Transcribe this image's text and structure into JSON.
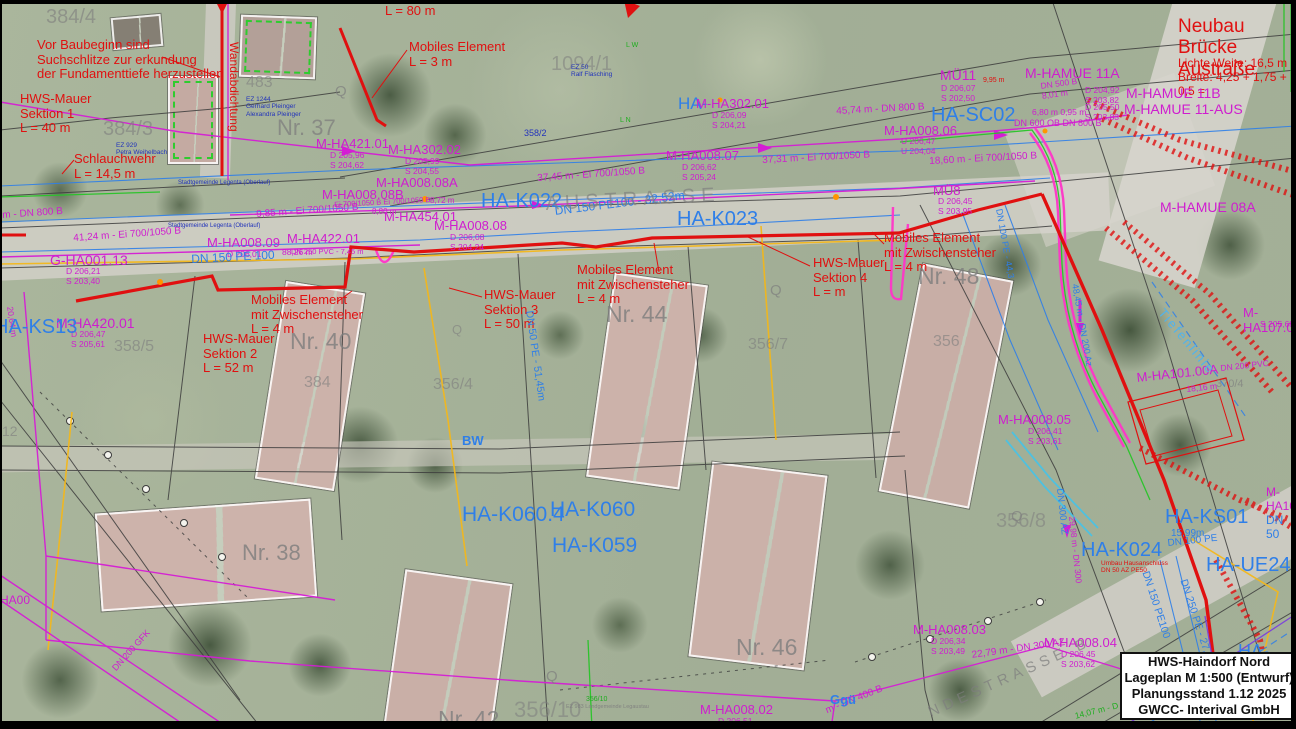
{
  "meta": {
    "plan_width": 1296,
    "plan_height": 729
  },
  "title_block": {
    "line1": "HWS-Haindorf Nord",
    "line2": "Lageplan M 1:500 (Entwurf)",
    "line3": "Planungsstand 1.12 2025",
    "line4": "GWCC- Interival GmbH"
  },
  "colors": {
    "red": "#e01010",
    "mag": "#cf1dcf",
    "blu": "#2f7fe8",
    "cy": "#4fb3ee",
    "gry": "#7e7e7e",
    "grn": "#1fae1f",
    "dblu": "#2233bb"
  },
  "houses": [
    {
      "n": "nr37-house",
      "x": 240,
      "y": 16,
      "w": 72,
      "h": 58,
      "r": 2,
      "roof": "#b3a098",
      "dash": true
    },
    {
      "n": "parcel-house",
      "x": 168,
      "y": 76,
      "w": 46,
      "h": 84,
      "r": 0,
      "roof": "#c4aaa2",
      "dash": true
    },
    {
      "n": "shed",
      "x": 112,
      "y": 16,
      "w": 46,
      "h": 28,
      "r": -5,
      "roof": "#857f74",
      "dash": false
    },
    {
      "n": "nr40-house",
      "x": 270,
      "y": 286,
      "w": 76,
      "h": 196,
      "r": 9,
      "roof": "#ccb2aa",
      "dash": false
    },
    {
      "n": "nr44-house",
      "x": 600,
      "y": 278,
      "w": 90,
      "h": 202,
      "r": 8,
      "roof": "#ccb2aa",
      "dash": false
    },
    {
      "n": "nr48-house",
      "x": 900,
      "y": 270,
      "w": 88,
      "h": 228,
      "r": 11,
      "roof": "#c8aea6",
      "dash": false
    },
    {
      "n": "nr38-house",
      "x": 98,
      "y": 506,
      "w": 212,
      "h": 94,
      "r": -4,
      "roof": "#cdb3ab",
      "dash": false
    },
    {
      "n": "nr42-house",
      "x": 394,
      "y": 576,
      "w": 104,
      "h": 153,
      "r": 8,
      "roof": "#c9afa7",
      "dash": false
    },
    {
      "n": "nr46-house",
      "x": 700,
      "y": 468,
      "w": 112,
      "h": 192,
      "r": 7,
      "roof": "#cbb1a9",
      "dash": false
    }
  ],
  "labels": [
    {
      "n": "note-suchschlitze",
      "t": "Vor Baubeginn sind\nSuchschlitze zur erkundung\nder Fundamenttiefe herzustellen",
      "x": 37,
      "y": 38,
      "c": "red",
      "s": 13
    },
    {
      "n": "hws-mauer-sektion-1",
      "t": "HWS-Mauer\nSektion 1\nL = 40 m",
      "x": 20,
      "y": 92,
      "c": "red",
      "s": 13
    },
    {
      "n": "schlauchwehr",
      "t": "Schlauchwehr\nL = 14,5 m",
      "x": 74,
      "y": 152,
      "c": "red",
      "s": 13
    },
    {
      "n": "wall-l80",
      "t": "L = 80 m",
      "x": 385,
      "y": 4,
      "c": "red",
      "s": 13
    },
    {
      "n": "mobiles-element-3m",
      "t": "Mobiles Element\nL = 3 m",
      "x": 409,
      "y": 40,
      "c": "red",
      "s": 13
    },
    {
      "n": "neubau-bruecke-austrasse",
      "t": "Neubau\nBrücke Austraße",
      "x": 1178,
      "y": 16,
      "c": "red",
      "s": 19
    },
    {
      "n": "lichte-weite",
      "t": "Lichte Weite: 16,5 m",
      "x": 1178,
      "y": 57,
      "c": "red",
      "s": 12
    },
    {
      "n": "breite",
      "t": "Breite: 4,25 + 1,75 + 0,5 = ",
      "x": 1178,
      "y": 71,
      "c": "red",
      "s": 12
    },
    {
      "n": "wandabdichtung",
      "t": "Wandabdichtung",
      "x": 240,
      "y": 42,
      "c": "red",
      "s": 12,
      "r": 90
    },
    {
      "n": "mobiles-element-zw-1",
      "t": "Mobiles Element\nmit Zwischensteher\nL = 4 m",
      "x": 251,
      "y": 293,
      "c": "red",
      "s": 13
    },
    {
      "n": "hws-mauer-sektion-2",
      "t": "HWS-Mauer\nSektion 2\nL = 52 m",
      "x": 203,
      "y": 332,
      "c": "red",
      "s": 13
    },
    {
      "n": "hws-mauer-sektion-3",
      "t": "HWS-Mauer\nSektion 3\nL = 50 m",
      "x": 484,
      "y": 288,
      "c": "red",
      "s": 13
    },
    {
      "n": "mobiles-element-zw-2",
      "t": "Mobiles Element\nmit Zwischensteher\nL = 4 m",
      "x": 577,
      "y": 263,
      "c": "red",
      "s": 13
    },
    {
      "n": "hws-mauer-sektion-4",
      "t": "HWS-Mauer\nSektion 4\nL =    m",
      "x": 813,
      "y": 256,
      "c": "red",
      "s": 13
    },
    {
      "n": "mobiles-element-zw-3",
      "t": "Mobiles Element\nmit Zwischensteher\nL = 4 m",
      "x": 884,
      "y": 231,
      "c": "red",
      "s": 13
    },
    {
      "n": "umbau-hausanschluss",
      "t": "Umbau Hausanschluss\nDN 50 AZ PE50",
      "x": 1101,
      "y": 560,
      "c": "red",
      "s": 6.5
    },
    {
      "n": "dim-9-95",
      "t": "9,95 m",
      "x": 983,
      "y": 77,
      "c": "red",
      "s": 7
    },
    {
      "t": "M-HA421.01",
      "x": 316,
      "y": 137,
      "c": "mag",
      "s": 13
    },
    {
      "t": "D 205,96\nS 204,62",
      "x": 330,
      "y": 151,
      "c": "mag",
      "s": 8.5
    },
    {
      "t": "M-HA302.02",
      "x": 388,
      "y": 143,
      "c": "mag",
      "s": 13
    },
    {
      "t": "D 205,99\nS 204,55",
      "x": 405,
      "y": 157,
      "c": "mag",
      "s": 8.5
    },
    {
      "t": "HA-",
      "x": 678,
      "y": 94,
      "c": "blu",
      "s": 17
    },
    {
      "t": "M-HA302.01",
      "x": 696,
      "y": 97,
      "c": "mag",
      "s": 13
    },
    {
      "t": "D 206,09\nS 204,21",
      "x": 712,
      "y": 111,
      "c": "mag",
      "s": 8.5
    },
    {
      "t": "M-HA008.08A",
      "x": 376,
      "y": 176,
      "c": "mag",
      "s": 13
    },
    {
      "t": "M-HA008.08B",
      "x": 322,
      "y": 188,
      "c": "mag",
      "s": 13
    },
    {
      "t": "Ei 700/1050 B  Ei 700/1050 B",
      "x": 334,
      "y": 201,
      "c": "mag",
      "s": 7.5,
      "r": -3
    },
    {
      "t": "8,80 m",
      "x": 372,
      "y": 207,
      "c": "mag",
      "s": 8
    },
    {
      "t": "8,72 m",
      "x": 430,
      "y": 196,
      "c": "mag",
      "s": 8
    },
    {
      "t": "M-HA454.01",
      "x": 384,
      "y": 210,
      "c": "mag",
      "s": 13
    },
    {
      "t": "M-HA008.08",
      "x": 434,
      "y": 219,
      "c": "mag",
      "s": 13
    },
    {
      "t": "D 206,08\nS 204,24",
      "x": 450,
      "y": 233,
      "c": "mag",
      "s": 8.5
    },
    {
      "t": "M-HA422.01",
      "x": 287,
      "y": 232,
      "c": "mag",
      "s": 13
    },
    {
      "t": "DN 250 PVC - 7,45 m",
      "x": 291,
      "y": 248,
      "c": "mag",
      "s": 7.5
    },
    {
      "t": "M-HA008.09",
      "x": 207,
      "y": 236,
      "c": "mag",
      "s": 13
    },
    {
      "t": "D 206,01",
      "x": 227,
      "y": 250,
      "c": "mag",
      "s": 8.5
    },
    {
      "t": "88,26 m",
      "x": 282,
      "y": 248,
      "c": "mag",
      "s": 8.5
    },
    {
      "t": "G-HA001.13",
      "x": 50,
      "y": 253,
      "c": "mag",
      "s": 14
    },
    {
      "t": "D 206,21\nS 203,40",
      "x": 66,
      "y": 267,
      "c": "mag",
      "s": 8.5
    },
    {
      "t": "M-HA420.01",
      "x": 56,
      "y": 316,
      "c": "mag",
      "s": 14
    },
    {
      "t": "D 206,47\nS 205,61",
      "x": 71,
      "y": 330,
      "c": "mag",
      "s": 8.5
    },
    {
      "t": "m - DN 800 B",
      "x": 2,
      "y": 210,
      "c": "mag",
      "s": 10,
      "r": -4
    },
    {
      "t": "41,24 m - Ei 700/1050 B",
      "x": 73,
      "y": 233,
      "c": "mag",
      "s": 10,
      "r": -4
    },
    {
      "t": "9,85 m - Ei 700/1050 B",
      "x": 256,
      "y": 209,
      "c": "mag",
      "s": 10,
      "r": -4
    },
    {
      "t": "37,45 m - Ei 700/1050 B",
      "x": 537,
      "y": 173,
      "c": "mag",
      "s": 10,
      "r": -4
    },
    {
      "t": "37,31 m - Ei 700/1050 B",
      "x": 762,
      "y": 155,
      "c": "mag",
      "s": 10,
      "r": -3
    },
    {
      "t": "18,60 m - Ei 700/1050 B",
      "x": 929,
      "y": 156,
      "c": "mag",
      "s": 10,
      "r": -3
    },
    {
      "t": "45,74 m - DN 800 B",
      "x": 836,
      "y": 106,
      "c": "mag",
      "s": 10,
      "r": -3
    },
    {
      "t": "M-HA008.07",
      "x": 666,
      "y": 149,
      "c": "mag",
      "s": 13
    },
    {
      "t": "D 206,62\nS 205,24",
      "x": 682,
      "y": 163,
      "c": "mag",
      "s": 8.5
    },
    {
      "t": "M-HA008.06",
      "x": 884,
      "y": 124,
      "c": "mag",
      "s": 13
    },
    {
      "t": "U 206,47\nU 204,04",
      "x": 901,
      "y": 137,
      "c": "mag",
      "s": 8.5
    },
    {
      "t": "MÜ11",
      "x": 940,
      "y": 68,
      "c": "mag",
      "s": 14
    },
    {
      "t": "D 206,07\nS 202,50",
      "x": 941,
      "y": 84,
      "c": "mag",
      "s": 8.5
    },
    {
      "t": "M-HAMUE 11A",
      "x": 1025,
      "y": 66,
      "c": "mag",
      "s": 14
    },
    {
      "t": "DN 500 B\n8,01 m",
      "x": 1040,
      "y": 82,
      "c": "mag",
      "s": 8.5,
      "r": -8
    },
    {
      "t": "D 204,92\nS 203,82",
      "x": 1085,
      "y": 86,
      "c": "mag",
      "s": 8.5
    },
    {
      "t": "M-HAMUE 11B",
      "x": 1126,
      "y": 86,
      "c": "mag",
      "s": 14
    },
    {
      "t": "D 205,50\nS 203,83",
      "x": 1085,
      "y": 103,
      "c": "mag",
      "s": 8.5
    },
    {
      "t": "M-HAMUE 11-AUS",
      "x": 1124,
      "y": 102,
      "c": "mag",
      "s": 14
    },
    {
      "t": "6,80 m  0,95 m",
      "x": 1032,
      "y": 108,
      "c": "mag",
      "s": 8.5
    },
    {
      "t": "DN 600 OB  DN 800 B",
      "x": 1014,
      "y": 118,
      "c": "mag",
      "s": 9
    },
    {
      "t": "M-HAMUE 08A",
      "x": 1160,
      "y": 200,
      "c": "mag",
      "s": 14
    },
    {
      "t": "M-HA107.0",
      "x": 1243,
      "y": 306,
      "c": "mag",
      "s": 13
    },
    {
      "t": "S 205,68",
      "x": 1260,
      "y": 320,
      "c": "mag",
      "s": 8.5
    },
    {
      "t": "M-HA101.00A",
      "x": 1136,
      "y": 371,
      "c": "mag",
      "s": 13,
      "r": -6
    },
    {
      "t": "18,16 m",
      "x": 1186,
      "y": 385,
      "c": "mag",
      "s": 8.5,
      "r": -6
    },
    {
      "t": "DN 200 PVC",
      "x": 1220,
      "y": 364,
      "c": "mag",
      "s": 8.5,
      "r": -6
    },
    {
      "t": "M-HA008.05",
      "x": 998,
      "y": 413,
      "c": "mag",
      "s": 13
    },
    {
      "t": "D 206,41\nS 203,61",
      "x": 1028,
      "y": 427,
      "c": "mag",
      "s": 8.5
    },
    {
      "t": "29,98 m - DN 300",
      "x": 1076,
      "y": 516,
      "c": "mag",
      "s": 8.5,
      "r": 84
    },
    {
      "t": "M-HA008.04",
      "x": 1044,
      "y": 636,
      "c": "mag",
      "s": 13
    },
    {
      "t": "D 206,45\nS 203,62",
      "x": 1061,
      "y": 650,
      "c": "mag",
      "s": 8.5
    },
    {
      "t": "22,79 m - DN 300 AZ",
      "x": 971,
      "y": 650,
      "c": "mag",
      "s": 10,
      "r": -8
    },
    {
      "t": "M-HA008.03",
      "x": 913,
      "y": 623,
      "c": "mag",
      "s": 13
    },
    {
      "t": "D 206,34\nS 203,49",
      "x": 931,
      "y": 637,
      "c": "mag",
      "s": 8.5
    },
    {
      "t": "m - DN 400 B",
      "x": 824,
      "y": 706,
      "c": "mag",
      "s": 10,
      "r": -22
    },
    {
      "t": "M-HA008.02",
      "x": 700,
      "y": 703,
      "c": "mag",
      "s": 13
    },
    {
      "t": "D 206,51",
      "x": 718,
      "y": 717,
      "c": "mag",
      "s": 8.5
    },
    {
      "t": "MÜ8",
      "x": 933,
      "y": 184,
      "c": "mag",
      "s": 13
    },
    {
      "t": "D 206,45\nS 203,95",
      "x": 938,
      "y": 197,
      "c": "mag",
      "s": 8.5
    },
    {
      "t": "20,64 m",
      "x": 14,
      "y": 306,
      "c": "mag",
      "s": 8.5,
      "r": 82
    },
    {
      "t": "DN 200 GFK",
      "x": 110,
      "y": 666,
      "c": "mag",
      "s": 9,
      "r": -48
    },
    {
      "t": "HA00",
      "x": 0,
      "y": 594,
      "c": "mag",
      "s": 12
    },
    {
      "t": "M-HA10",
      "x": 1266,
      "y": 486,
      "c": "mag",
      "s": 12
    },
    {
      "t": "14,07 m - D",
      "x": 1074,
      "y": 712,
      "c": "grn",
      "s": 8.5,
      "r": -14
    },
    {
      "t": "HA-K022",
      "x": 481,
      "y": 190,
      "c": "blu",
      "s": 20
    },
    {
      "t": "HA-K023",
      "x": 677,
      "y": 208,
      "c": "blu",
      "s": 20
    },
    {
      "t": "HA-SC02",
      "x": 931,
      "y": 104,
      "c": "blu",
      "s": 20
    },
    {
      "t": "HA-K060.4",
      "x": 462,
      "y": 503,
      "c": "blu",
      "s": 21
    },
    {
      "t": "HA-K060",
      "x": 550,
      "y": 498,
      "c": "blu",
      "s": 21
    },
    {
      "t": "HA-K059",
      "x": 552,
      "y": 534,
      "c": "blu",
      "s": 21
    },
    {
      "t": "HA-K024",
      "x": 1081,
      "y": 539,
      "c": "blu",
      "s": 20
    },
    {
      "t": "HA-KS01",
      "x": 1165,
      "y": 506,
      "c": "blu",
      "s": 20
    },
    {
      "t": "15,99m",
      "x": 1171,
      "y": 528,
      "c": "blu",
      "s": 10
    },
    {
      "t": "DN 100 PE",
      "x": 1167,
      "y": 538,
      "c": "blu",
      "s": 10,
      "r": -6
    },
    {
      "t": "HA-UE24",
      "x": 1206,
      "y": 554,
      "c": "blu",
      "s": 20
    },
    {
      "t": "HA-KS13",
      "x": -6,
      "y": 316,
      "c": "blu",
      "s": 20
    },
    {
      "n": "bw-label",
      "t": "BW",
      "x": 462,
      "y": 434,
      "c": "blu",
      "s": 13,
      "w": 700
    },
    {
      "n": "ggue-label",
      "t": "Ggü",
      "x": 830,
      "y": 693,
      "c": "blu",
      "s": 13,
      "w": 700
    },
    {
      "t": "HA-K02",
      "x": 1238,
      "y": 641,
      "c": "blu",
      "s": 18
    },
    {
      "t": "DN 150 PE 100",
      "x": 191,
      "y": 253,
      "c": "blu",
      "s": 12,
      "r": -3
    },
    {
      "t": "DN 150 PE100 - 32,52m",
      "x": 554,
      "y": 205,
      "c": "blu",
      "s": 12,
      "r": -7
    },
    {
      "t": "DN 50 PE - 51,45m",
      "x": 534,
      "y": 310,
      "c": "blu",
      "s": 10.5,
      "r": 82
    },
    {
      "t": "DN 150 PE100",
      "x": 1150,
      "y": 570,
      "c": "blu",
      "s": 10.5,
      "r": 72
    },
    {
      "t": "DN 250 PE - 27,07",
      "x": 1188,
      "y": 578,
      "c": "blu",
      "s": 10.5,
      "r": 72
    },
    {
      "t": "DN 50",
      "x": 1266,
      "y": 514,
      "c": "blu",
      "s": 12
    },
    {
      "n": "tiefenlinie-label",
      "t": "Tiefenlinie",
      "x": 1166,
      "y": 306,
      "c": "cy",
      "s": 13,
      "r": 50,
      "ls": 2
    },
    {
      "t": "DN 300 AZ",
      "x": 1064,
      "y": 488,
      "c": "blu",
      "s": 9.5,
      "r": 84
    },
    {
      "t": "DN 100 PE - 44,3",
      "x": 1004,
      "y": 208,
      "c": "blu",
      "s": 9,
      "r": 80
    },
    {
      "t": "48,45 m - DN 200 Az",
      "x": 1080,
      "y": 283,
      "c": "blu",
      "s": 9,
      "r": 80
    },
    {
      "t": "358/2",
      "x": 524,
      "y": 128,
      "c": "dblu",
      "s": 9
    },
    {
      "t": "384/4",
      "x": 46,
      "y": 6,
      "c": "gry",
      "s": 20,
      "o": 0.6
    },
    {
      "t": "384/3",
      "x": 103,
      "y": 118,
      "c": "gry",
      "s": 20,
      "o": 0.6
    },
    {
      "t": "483",
      "x": 246,
      "y": 74,
      "c": "gry",
      "s": 16,
      "o": 0.6
    },
    {
      "t": "Nr. 37",
      "x": 277,
      "y": 116,
      "c": "gry",
      "s": 22,
      "o": 0.75
    },
    {
      "t": "1094/1",
      "x": 551,
      "y": 53,
      "c": "gry",
      "s": 20,
      "o": 0.55
    },
    {
      "t": "358/5",
      "x": 114,
      "y": 338,
      "c": "gry",
      "s": 16,
      "o": 0.6
    },
    {
      "t": "356/4",
      "x": 433,
      "y": 376,
      "c": "gry",
      "s": 16,
      "o": 0.6
    },
    {
      "t": "384",
      "x": 304,
      "y": 374,
      "c": "gry",
      "s": 16,
      "o": 0.6
    },
    {
      "t": "356/7",
      "x": 748,
      "y": 336,
      "c": "gry",
      "s": 16,
      "o": 0.6
    },
    {
      "t": "356",
      "x": 933,
      "y": 333,
      "c": "gry",
      "s": 16,
      "o": 0.6
    },
    {
      "t": "356/8",
      "x": 996,
      "y": 510,
      "c": "gry",
      "s": 20,
      "o": 0.55
    },
    {
      "t": "356/10",
      "x": 514,
      "y": 698,
      "c": "gry",
      "s": 22,
      "o": 0.55
    },
    {
      "t": "Nr. 38",
      "x": 242,
      "y": 541,
      "c": "gry",
      "s": 22,
      "o": 0.8
    },
    {
      "t": "Nr. 40",
      "x": 290,
      "y": 328,
      "c": "gry",
      "s": 23,
      "o": 0.8
    },
    {
      "t": "Nr. 42",
      "x": 438,
      "y": 706,
      "c": "gry",
      "s": 23,
      "o": 0.8
    },
    {
      "t": "Nr. 44",
      "x": 606,
      "y": 301,
      "c": "gry",
      "s": 23,
      "o": 0.8
    },
    {
      "t": "Nr. 46",
      "x": 736,
      "y": 634,
      "c": "gry",
      "s": 23,
      "o": 0.8
    },
    {
      "t": "Nr. 48",
      "x": 918,
      "y": 263,
      "c": "gry",
      "s": 23,
      "o": 0.8
    },
    {
      "t": "12",
      "x": 2,
      "y": 424,
      "c": "gry",
      "s": 14,
      "o": 0.6
    },
    {
      "t": "370/4",
      "x": 1216,
      "y": 378,
      "c": "gry",
      "s": 11,
      "o": 0.7
    },
    {
      "n": "street-name-austrasse",
      "t": "AUSTRASSE",
      "x": 545,
      "y": 193,
      "c": "gry",
      "s": 20,
      "ls": 6,
      "r": -3,
      "o": 0.65
    },
    {
      "n": "street-name-landesstrasse",
      "t": "NDESTRASSE B",
      "x": 926,
      "y": 706,
      "c": "gry",
      "s": 15,
      "ls": 5,
      "r": -24,
      "o": 0.7
    },
    {
      "t": "Q",
      "x": 335,
      "y": 84,
      "c": "gry",
      "s": 15,
      "o": 0.7
    },
    {
      "t": "Q",
      "x": 770,
      "y": 283,
      "c": "gry",
      "s": 15,
      "o": 0.7
    },
    {
      "t": "Q",
      "x": 1011,
      "y": 509,
      "c": "gry",
      "s": 15,
      "o": 0.7
    },
    {
      "t": "Q",
      "x": 546,
      "y": 669,
      "c": "gry",
      "s": 15,
      "o": 0.7
    },
    {
      "t": "Q",
      "x": 452,
      "y": 323,
      "c": "gry",
      "s": 13,
      "o": 0.6
    },
    {
      "t": "EZ 1244\nGerhard Pleinger\nAlexandra Pleinger",
      "x": 246,
      "y": 96,
      "c": "dblu",
      "s": 6.5
    },
    {
      "t": "EZ 929\nPetra Weihelbach",
      "x": 116,
      "y": 142,
      "c": "dblu",
      "s": 6.5
    },
    {
      "t": "EZ 50\nRalf Flasching",
      "x": 571,
      "y": 64,
      "c": "dblu",
      "s": 6.5
    },
    {
      "t": "Stadtgemeinde Legenta (Oberlauf)",
      "x": 178,
      "y": 180,
      "c": "dblu",
      "s": 6
    },
    {
      "t": "Stadtgemeinde Legenta (Oberlauf)",
      "x": 168,
      "y": 223,
      "c": "dblu",
      "s": 6
    },
    {
      "t": "356/10",
      "x": 586,
      "y": 696,
      "c": "grn",
      "s": 7
    },
    {
      "t": "EZ 983 Landgemeinde Legaustau",
      "x": 566,
      "y": 704,
      "c": "gry",
      "s": 5.5,
      "o": 0.9
    },
    {
      "t": "L W",
      "x": 626,
      "y": 42,
      "c": "grn",
      "s": 7
    },
    {
      "t": "L N",
      "x": 620,
      "y": 117,
      "c": "grn",
      "s": 7
    }
  ]
}
